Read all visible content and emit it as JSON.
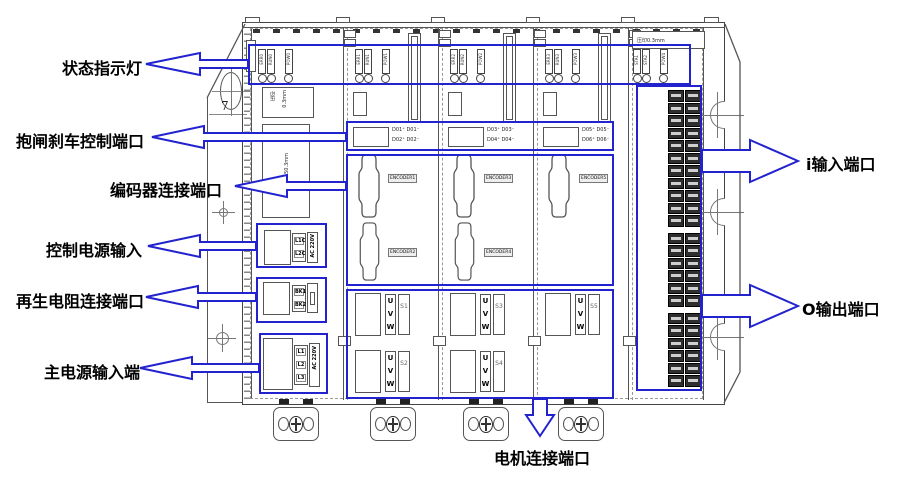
{
  "colors": {
    "annotation_blue": "#2222cf",
    "line_gray": "#555555"
  },
  "labels": {
    "left": [
      "状态指示灯",
      "抱闸刹车控制端口",
      "编码器连接端口",
      "控制电源输入",
      "再生电阻连接端口",
      "主电源输入端"
    ],
    "right": [
      "i输入端口",
      "O输出端口"
    ],
    "bottom": "电机连接端口"
  },
  "dimension": "7",
  "power_module": {
    "imprint_col1": "压印",
    "imprint_col2": "0.3mm",
    "height_mark": "H150.3mm",
    "control_power": {
      "pin1": "L1C",
      "pin2": "L2C",
      "voltage": "AC 220V"
    },
    "regen": {
      "pin1": "BK1",
      "pin2": "BK2"
    },
    "main_power": {
      "pin1": "L1",
      "pin2": "L2",
      "pin3": "L3",
      "voltage": "AC 220V"
    }
  },
  "led_groups": [
    [
      "ERR0",
      "RUN0",
      "POW0"
    ],
    [
      "ERR1",
      "RUN1",
      "POW1"
    ],
    [
      "ERR2",
      "RUN2",
      "POW2"
    ],
    [
      "ERR3",
      "RUN3",
      "POW3"
    ],
    [
      "STA1",
      "STA2",
      "POW4"
    ]
  ],
  "axis_modules": [
    {
      "brake_line1": "D01⁺ D01⁻",
      "brake_line2": "D02⁺ D02⁻",
      "encoder1": "ENCODER1",
      "encoder2": "ENCODER2",
      "motor1_id": "S1",
      "motor2_id": "S2"
    },
    {
      "brake_line1": "D03⁺ D03⁻",
      "brake_line2": "D04⁺ D04⁻",
      "encoder1": "ENCODER3",
      "encoder2": "ENCODER4",
      "motor1_id": "S3",
      "motor2_id": "S4"
    },
    {
      "brake_line1": "D05⁺ D05⁻",
      "brake_line2": "D06⁺ D06⁻",
      "encoder1": "ENCODER5",
      "motor1_id": "S5"
    }
  ],
  "phases": [
    "U",
    "V",
    "W"
  ],
  "io_module": {
    "imprint": "压印0.3mm"
  }
}
